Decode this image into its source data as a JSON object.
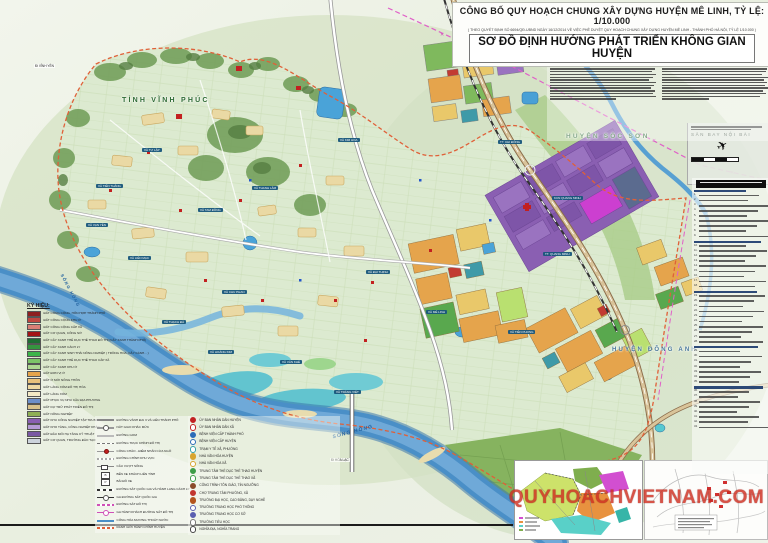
{
  "title": {
    "line1": "CÔNG BỐ QUY HOẠCH CHUNG XÂY DỰNG HUYỆN MÊ LINH, TỶ LỆ: 1/10.000",
    "line2": "( THEO QUYẾT ĐỊNH SỐ 6694/QĐ-UBND NGÀY 16/12/2014 VỀ VIỆC PHÊ DUYỆT QUY HOẠCH CHUNG XÂY DỰNG HUYỆN MÊ LINH - THÀNH PHỐ HÀ NỘI, TỶ LỆ 1/10.000 )",
    "line3": "SƠ ĐỒ ĐỊNH HƯỚNG PHÁT TRIỂN KHÔNG GIAN HUYỆN"
  },
  "notes": {
    "heading": "Định hướng phát triển không gian chung:"
  },
  "watermark": "QUYHOACHVIETNAM.COM",
  "map": {
    "inset_airport": {
      "label": "SÂN BAY NỘI BÀI"
    },
    "region_labels": [
      {
        "text": "TỈNH VĨNH PHÚC",
        "x": 122,
        "y": 97,
        "size": 7,
        "color": "#2f6b35",
        "rot": 0
      },
      {
        "text": "HUYỆN SÓC SƠN",
        "x": 566,
        "y": 133,
        "size": 6.5,
        "color": "#3f7747",
        "rot": 0
      },
      {
        "text": "HUYỆN ĐÔNG ANH",
        "x": 612,
        "y": 347,
        "size": 6,
        "color": "#49789c",
        "rot": 0
      }
    ],
    "river_labels": [
      {
        "text": "SÔNG HỒNG",
        "x": 332,
        "y": 429,
        "rot": -15,
        "size": 5
      },
      {
        "text": "SÔNG HỒNG",
        "x": 52,
        "y": 288,
        "rot": 62,
        "size": 4.2
      }
    ],
    "direction_labels": [
      {
        "text": "Đi HÒA LẠC",
        "x": 330,
        "y": 458
      },
      {
        "text": "Đi VĨNH YÊN",
        "x": 34,
        "y": 64
      },
      {
        "text": "Đi NỘI BÀI",
        "x": 636,
        "y": 58
      }
    ],
    "commune_tags": [
      {
        "text": "TT. CHI ĐÔNG",
        "x": 498,
        "y": 140
      },
      {
        "text": "XÃ KIM HOA",
        "x": 338,
        "y": 138
      },
      {
        "text": "XÃ TỰ LẬP",
        "x": 142,
        "y": 148
      },
      {
        "text": "XÃ TIẾN THẮNG",
        "x": 96,
        "y": 184
      },
      {
        "text": "XÃ VẠN YÊN",
        "x": 86,
        "y": 223
      },
      {
        "text": "XÃ TAM ĐỒNG",
        "x": 198,
        "y": 208
      },
      {
        "text": "XÃ THANH LÂM",
        "x": 252,
        "y": 186
      },
      {
        "text": "XÃ LIÊN MẠC",
        "x": 128,
        "y": 256
      },
      {
        "text": "XÃ CHU PHAN",
        "x": 222,
        "y": 290
      },
      {
        "text": "XÃ THẠCH ĐÀ",
        "x": 162,
        "y": 320
      },
      {
        "text": "XÃ HOÀNG KIM",
        "x": 208,
        "y": 350
      },
      {
        "text": "XÃ VĂN KHÊ",
        "x": 280,
        "y": 360
      },
      {
        "text": "XÃ TRÁNG VIỆT",
        "x": 334,
        "y": 390
      },
      {
        "text": "XÃ MÊ LINH",
        "x": 426,
        "y": 310
      },
      {
        "text": "XÃ ĐẠI THỊNH",
        "x": 366,
        "y": 270
      },
      {
        "text": "XÃ TIỀN PHONG",
        "x": 508,
        "y": 330
      },
      {
        "text": "TT. QUANG MINH",
        "x": 543,
        "y": 252
      },
      {
        "text": "KCN QUANG MINH",
        "x": 552,
        "y": 196
      }
    ]
  },
  "legend_left": {
    "title": "KÝ HIỆU:",
    "items": [
      {
        "color": "#8e1f1f",
        "label": "ĐẤT CÔNG CỘNG, HỖN HỢP THÀNH PHỐ"
      },
      {
        "color": "#c0463f",
        "label": "ĐẤT CÔNG CỘNG KHU Ở"
      },
      {
        "color": "#d97f76",
        "label": "ĐẤT CÔNG CỘNG CẤP XÃ"
      },
      {
        "color": "#a31515",
        "label": "ĐẤT CƠ QUAN, CÔNG SỞ"
      },
      {
        "color": "#1f6e33",
        "label": "ĐẤT CÂY XANH THỂ DỤC THỂ THAO ĐÔ THỊ (CÂY XANH THÀNH PHỐ)"
      },
      {
        "color": "#35953f",
        "label": "ĐẤT CÂY XANH CÁCH LY"
      },
      {
        "color": "#3db54a",
        "label": "ĐẤT CÂY XANH SINH THÁI NÔNG NGHIỆP ( TRỒNG HOA, CÂY CẢNH... )"
      },
      {
        "color": "#7cc468",
        "label": "ĐẤT CÂY XANH THỂ DỤC THỂ THAO CẤP XÃ"
      },
      {
        "color": "#aed792",
        "label": "ĐẤT CÂY XANH KHU Ở"
      },
      {
        "color": "#e5a44c",
        "label": "ĐẤT ĐƠN VỊ Ở"
      },
      {
        "color": "#e9c27c",
        "label": "ĐẤT Ở MỚI NÔNG THÔN"
      },
      {
        "color": "#efd9a2",
        "label": "ĐẤT LÀNG XÓM ĐÔ THỊ HÓA"
      },
      {
        "color": "#f3e9c4",
        "label": "ĐẤT LÀNG XÓM"
      },
      {
        "color": "#6d8fc9",
        "label": "ĐẤT PHỤC VỤ NHU CẦU ĐỊA PHƯƠNG"
      },
      {
        "color": "#d9c28a",
        "label": "ĐẤT DỰ TRỮ PHÁT TRIỂN ĐÔ THỊ"
      },
      {
        "color": "#8fb055",
        "label": "ĐẤT NÔNG NGHIỆP"
      },
      {
        "color": "#8a5fb2",
        "label": "ĐẤT KHU CÔNG NGHIỆP TẬP TRUNG"
      },
      {
        "color": "#b69bd6",
        "label": "ĐẤT KHO TÀNG, CÔNG NGHIỆP KHÁC"
      },
      {
        "color": "#7a59a3",
        "label": "ĐẤT ĐẦU MỐI HẠ TẦNG KỸ THUẬT"
      },
      {
        "color": "#ccd3dc",
        "label": "ĐẤT CƠ QUAN, TRƯỜNG ĐÀO TẠO"
      }
    ]
  },
  "legend_lines": {
    "items": [
      {
        "glyph": "road-major",
        "label": "ĐƯỜNG VÀNH ĐAI 3 VÀ LIÊN THÀNH PHỐ"
      },
      {
        "glyph": "junction",
        "label": "NÚT GIAO KHÁC MỨC"
      },
      {
        "glyph": "road-minor",
        "label": "ĐƯỜNG GOM"
      },
      {
        "glyph": "road-dash",
        "label": "ĐƯỜNG TRỤC CHÍNH ĐÔ THỊ"
      },
      {
        "glyph": "gate",
        "label": "CỔNG CHÀO - ĐIỂM NHẤN CỬA NGÕ"
      },
      {
        "glyph": "road-dash2",
        "label": "ĐƯỜNG CHÍNH KHU VỰC"
      },
      {
        "glyph": "bridge",
        "label": "CẦU VƯỢT SÔNG"
      },
      {
        "glyph": "busstation",
        "label": "BẾN XE KHÁCH LIÊN TỈNH"
      },
      {
        "glyph": "parking",
        "label": "BÃI ĐỖ XE"
      },
      {
        "glyph": "rail",
        "label": "ĐƯỜNG SẮT QUỐC GIA VÀ HÀNH LANG CÁCH LY"
      },
      {
        "glyph": "rail-station",
        "label": "GA ĐƯỜNG SẮT QUỐC GIA"
      },
      {
        "glyph": "metro",
        "label": "ĐƯỜNG SẮT ĐÔ THỊ"
      },
      {
        "glyph": "metro-station",
        "label": "GA HÀNH KHÁCH ĐƯỜNG SẮT ĐÔ THỊ"
      },
      {
        "glyph": "canal",
        "label": "CỐNG HÓA MƯƠNG THOÁT NƯỚC"
      },
      {
        "glyph": "boundary",
        "label": "RANH GIỚI HÀNH CHÍNH HUYỆN"
      }
    ]
  },
  "legend_symbols": {
    "items": [
      {
        "color": "#c22222",
        "ring": false,
        "label": "ỦY BAN NHÂN DÂN HUYỆN"
      },
      {
        "color": "#c22222",
        "ring": true,
        "label": "ỦY BAN NHÂN DÂN XÃ"
      },
      {
        "color": "#2b6cb8",
        "ring": false,
        "label": "BỆNH VIỆN CẤP THÀNH PHỐ"
      },
      {
        "color": "#2b6cb8",
        "ring": true,
        "label": "BỆNH VIỆN CẤP HUYỆN"
      },
      {
        "color": "#35a0a8",
        "ring": true,
        "label": "TRẠM Y TẾ XÃ, PHƯỜNG"
      },
      {
        "color": "#d8a52e",
        "ring": false,
        "label": "NHÀ VĂN HÓA HUYỆN"
      },
      {
        "color": "#d8a52e",
        "ring": true,
        "label": "NHÀ VĂN HÓA XÃ"
      },
      {
        "color": "#3f9e48",
        "ring": false,
        "label": "TRUNG TÂM THỂ DỤC THỂ THAO HUYỆN"
      },
      {
        "color": "#3f9e48",
        "ring": true,
        "label": "TRUNG TÂM THỂ DỤC THỂ THAO XÃ"
      },
      {
        "color": "#8a4b2a",
        "ring": false,
        "label": "CÔNG TRÌNH TÔN GIÁO, TÍN NGƯỠNG"
      },
      {
        "color": "#c2362e",
        "ring": false,
        "label": "CHỢ TRUNG TÂM PHƯỜNG, XÃ"
      },
      {
        "color": "#b3541e",
        "ring": false,
        "label": "TRƯỜNG ĐẠI HỌC, CAO ĐẲNG, DẠY NGHỀ"
      },
      {
        "color": "#5a5fb0",
        "ring": true,
        "label": "TRƯỜNG TRUNG HỌC PHỔ THÔNG"
      },
      {
        "color": "#5a5fb0",
        "ring": false,
        "label": "TRƯỜNG TRUNG HỌC CƠ SỞ"
      },
      {
        "color": "#777777",
        "ring": true,
        "label": "TRƯỜNG TIỂU HỌC"
      },
      {
        "color": "#444444",
        "ring": true,
        "label": "NGHĨA ĐỊA, NGHĨA TRANG"
      }
    ]
  }
}
